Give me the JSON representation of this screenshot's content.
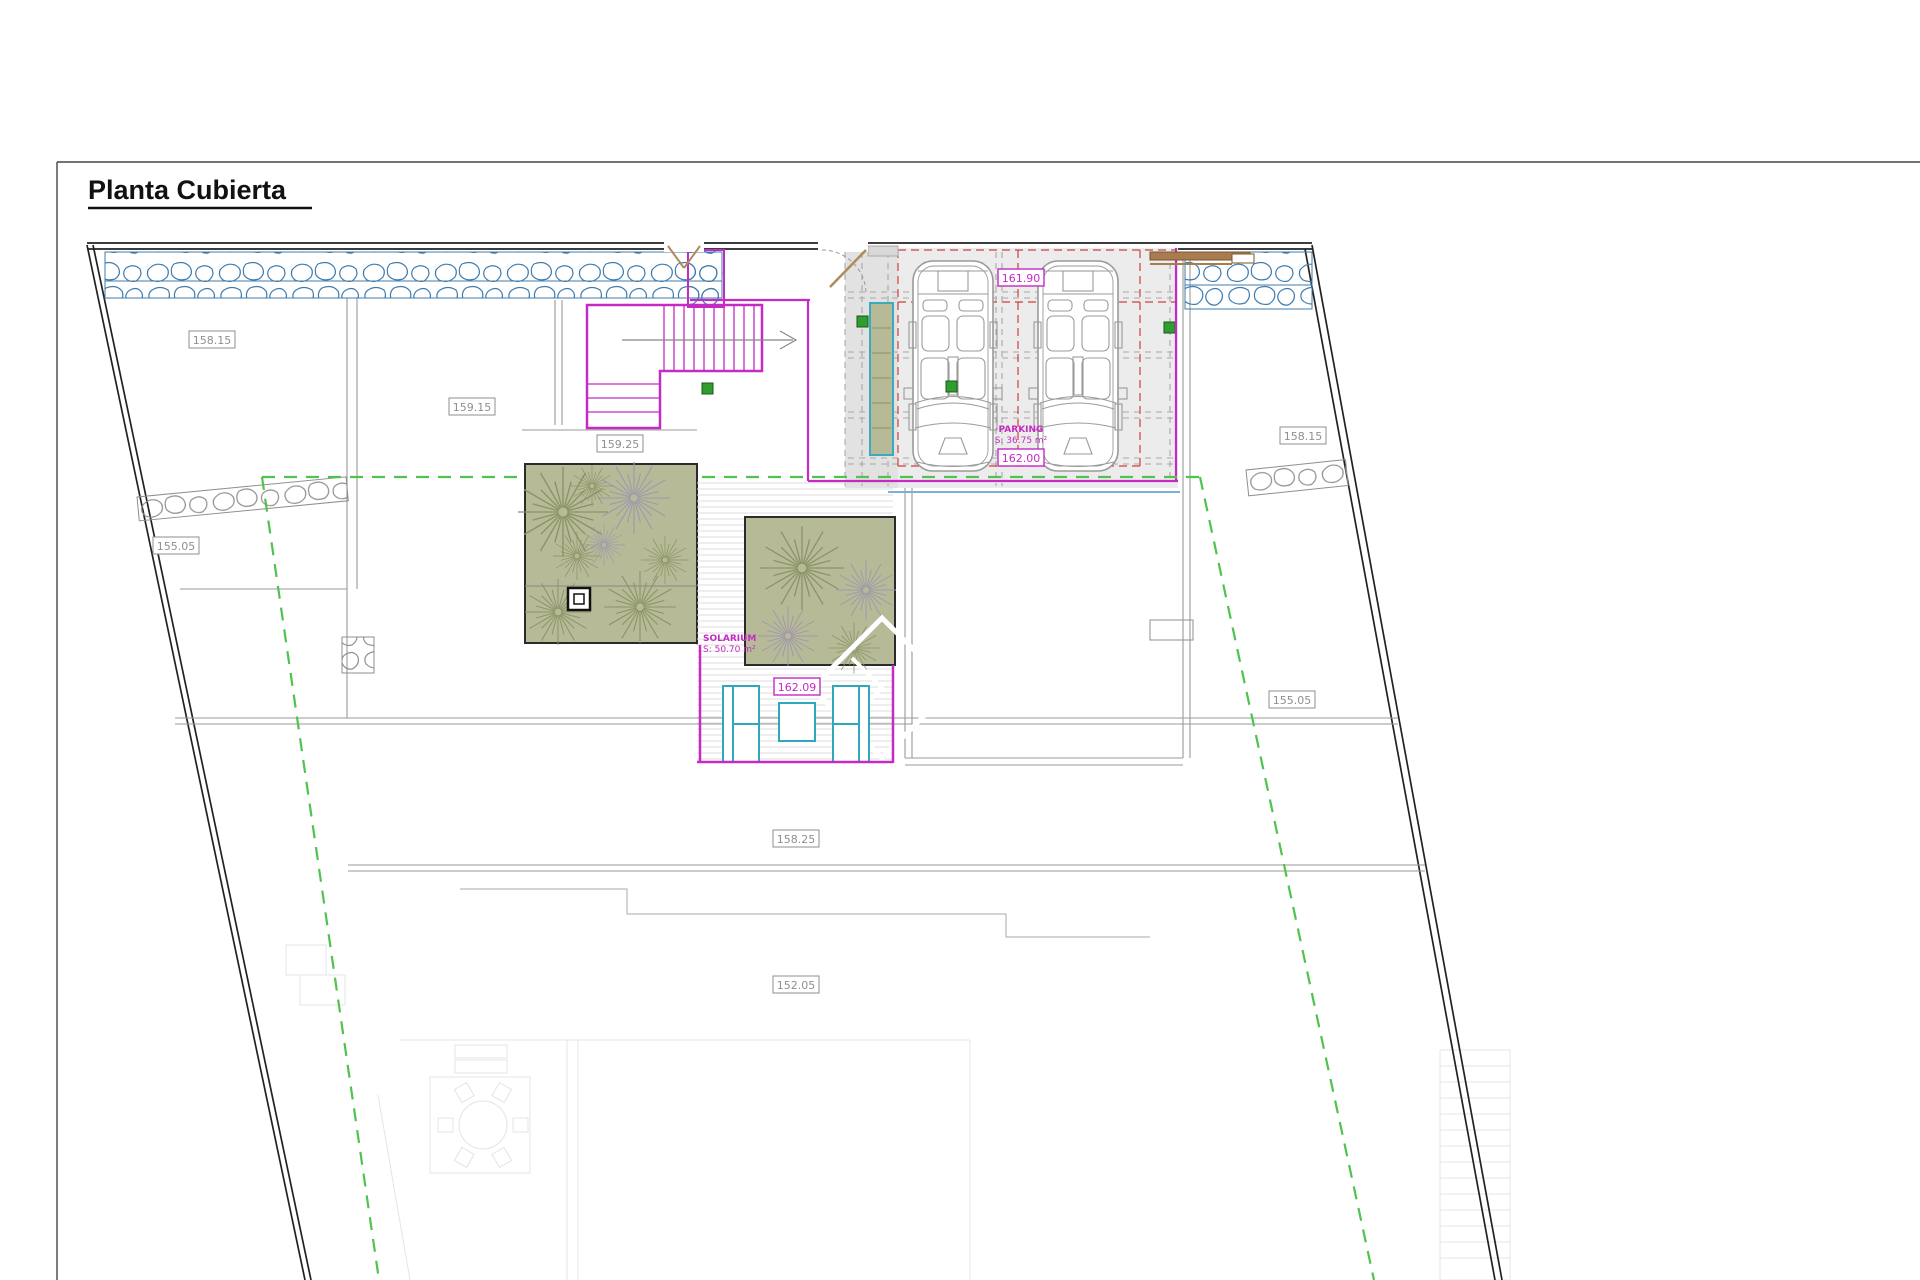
{
  "title": "Planta Cubierta",
  "labels": {
    "elevations": [
      {
        "text": "158.15"
      },
      {
        "text": "159.15"
      },
      {
        "text": "159.25"
      },
      {
        "text": "158.15"
      },
      {
        "text": "155.05"
      },
      {
        "text": "155.05"
      },
      {
        "text": "158.25"
      },
      {
        "text": "152.05"
      }
    ],
    "magenta": [
      {
        "text": "161.90"
      },
      {
        "text": "162.00"
      },
      {
        "text": "162.09"
      }
    ],
    "parking": {
      "name": "PARKING",
      "area": "S: 36.75 m²"
    },
    "solarium": {
      "name": "SOLARIUM",
      "area": "S: 50.70 m²"
    }
  },
  "colors": {
    "magenta": "#c32bc3",
    "stone_blue": "#3f7cae",
    "setback_green": "#4ec44e",
    "pergola_red": "#d04040",
    "roof_garden": "#b7ba97",
    "furniture_teal": "#2fa7bd",
    "wood_brown": "#a97c50"
  }
}
